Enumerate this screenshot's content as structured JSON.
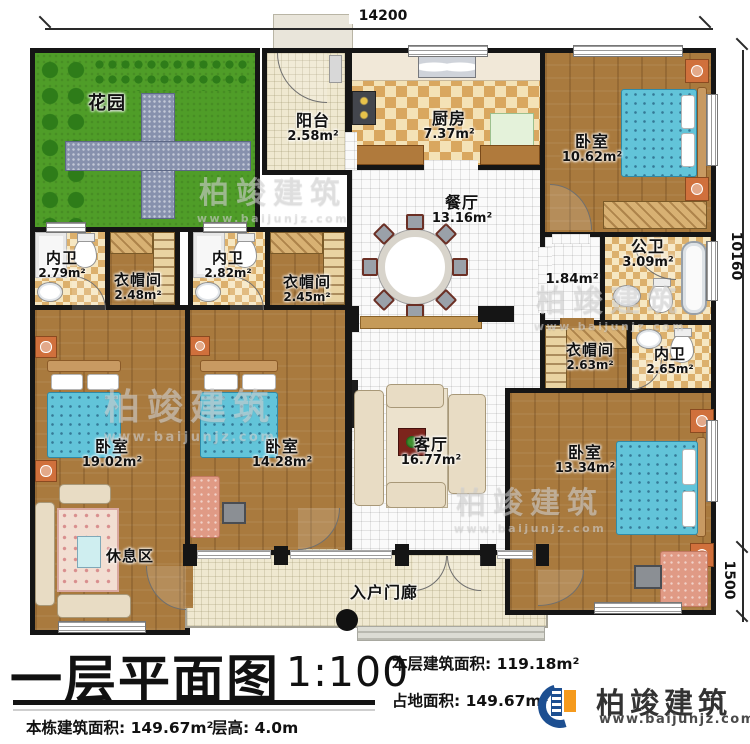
{
  "title_block": {
    "title": "一层平面图",
    "scale": "1:100",
    "floor_area_label": "本层建筑面积:",
    "floor_area": "119.18m²",
    "land_area_label": "占地面积:",
    "land_area": "149.67m²",
    "total_area_label": "本栋建筑面积:",
    "total_area": "149.67m²",
    "height_label": "层高:",
    "height": "4.0m"
  },
  "brand": {
    "name": "柏竣建筑",
    "site": "www.baijunjz.com"
  },
  "watermark": {
    "name": "柏竣建筑",
    "site": "www.baijunjz.com"
  },
  "dims": {
    "top": "14200",
    "right_upper": "10160",
    "right_lower": "1500"
  },
  "colors": {
    "accent_blue": "#1d4f91",
    "accent_orange": "#f59a1d",
    "wall": "#151515"
  },
  "rooms": {
    "garden": {
      "name": "花园",
      "area": ""
    },
    "balcony": {
      "name": "阳台",
      "area": "2.58m²"
    },
    "kitchen": {
      "name": "厨房",
      "area": "7.37m²"
    },
    "dining": {
      "name": "餐厅",
      "area": "13.16m²"
    },
    "bedroom_tr": {
      "name": "卧室",
      "area": "10.62m²"
    },
    "public_bath": {
      "name": "公卫",
      "area": "3.09m²"
    },
    "hall": {
      "name": "",
      "area": "1.84m²"
    },
    "bath1": {
      "name": "内卫",
      "area": "2.79m²"
    },
    "closet1": {
      "name": "衣帽间",
      "area": "2.48m²"
    },
    "bath2": {
      "name": "内卫",
      "area": "2.82m²"
    },
    "closet2": {
      "name": "衣帽间",
      "area": "2.45m²"
    },
    "closet_r": {
      "name": "衣帽间",
      "area": "2.63m²"
    },
    "bath_r": {
      "name": "内卫",
      "area": "2.65m²"
    },
    "bedroom1": {
      "name": "卧室",
      "area": "19.02m²"
    },
    "bedroom2": {
      "name": "卧室",
      "area": "14.28m²"
    },
    "living": {
      "name": "客厅",
      "area": "16.77m²"
    },
    "bedroom_br": {
      "name": "卧室",
      "area": "13.34m²"
    },
    "rest": {
      "name": "休息区",
      "area": ""
    },
    "porch": {
      "name": "入户门廊",
      "area": ""
    }
  }
}
